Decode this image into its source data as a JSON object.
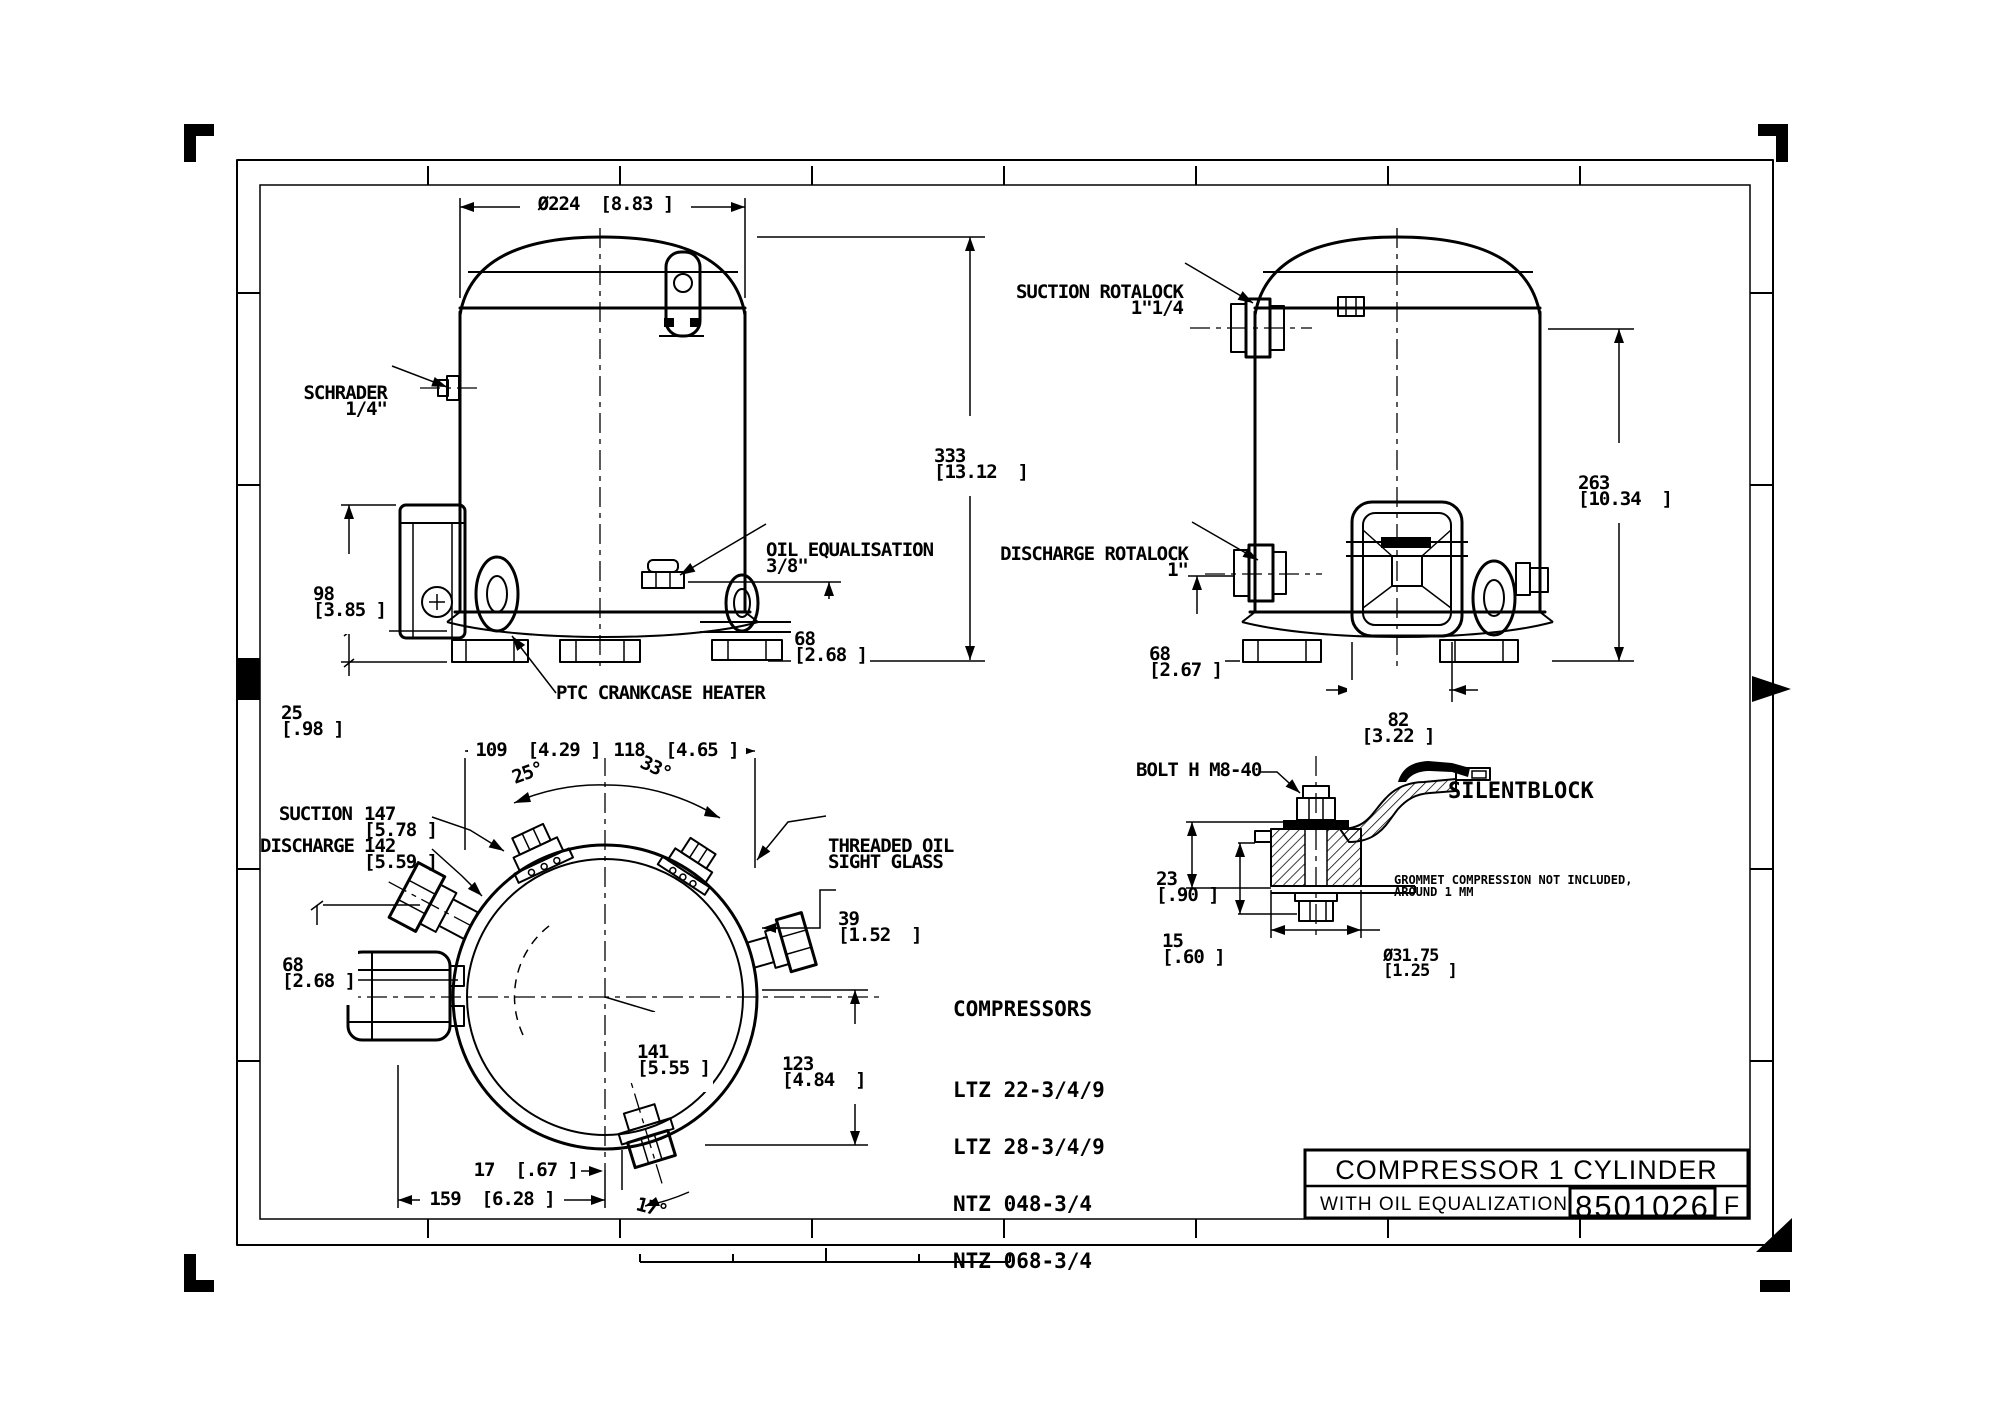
{
  "front_view": {
    "dim_diameter": "Ø224  [8.83 ]",
    "schrader": [
      "SCHRADER",
      "1/4\""
    ],
    "dim_height": {
      "mm": "333",
      "in": "[13.12  ]"
    },
    "oil_eq": [
      "OIL EQUALISATION",
      "3/8\""
    ],
    "dim_68": {
      "mm": "68",
      "in": "[2.68 ]"
    },
    "dim_98": {
      "mm": "98",
      "in": "[3.85 ]"
    },
    "dim_25": {
      "mm": "25",
      "in": "[.98 ]"
    },
    "ptc": "PTC CRANKCASE HEATER"
  },
  "side_view": {
    "suction": [
      "SUCTION ROTALOCK",
      "1\"1/4"
    ],
    "discharge": [
      "DISCHARGE ROTALOCK",
      "1\""
    ],
    "dim_height": {
      "mm": "263",
      "in": "[10.34  ]"
    },
    "dim_68": {
      "mm": "68",
      "in": "[2.67 ]"
    },
    "dim_82": {
      "mm": "82",
      "in": "[3.22 ]"
    }
  },
  "bottom_view": {
    "dim_109": "109  [4.29 ]",
    "dim_118": "118  [4.65 ]",
    "angle_25": "25°",
    "angle_33": "33°",
    "suction_label": "SUCTION",
    "suction_mm": "147",
    "suction_in": "[5.78 ]",
    "discharge_label": "DISCHARGE",
    "discharge_mm": "142",
    "discharge_in": "[5.59 ]",
    "sight_glass": [
      "THREADED OIL",
      "SIGHT GLASS"
    ],
    "dim_39": {
      "mm": "39",
      "in": "[1.52  ]"
    },
    "dim_68": {
      "mm": "68",
      "in": "[2.68 ]"
    },
    "dim_141": {
      "mm": "141",
      "in": "[5.55 ]"
    },
    "dim_123": {
      "mm": "123",
      "in": "[4.84  ]"
    },
    "dim_17": "17  [.67 ]",
    "dim_159": "159  [6.28 ]",
    "angle_17": "17°"
  },
  "silentblock": {
    "bolt": "BOLT H M8-40",
    "title": "SILENTBLOCK",
    "note": [
      "GROMMET COMPRESSION NOT INCLUDED,",
      "AROUND 1 MM"
    ],
    "dim_23": {
      "mm": "23",
      "in": "[.90 ]"
    },
    "dim_15": {
      "mm": "15",
      "in": "[.60 ]"
    },
    "dim_dia": {
      "mm": "Ø31.75",
      "in": "[1.25  ]"
    }
  },
  "compressors": {
    "title": "COMPRESSORS",
    "models": [
      "LTZ 22-3/4/9",
      "LTZ 28-3/4/9",
      "NTZ 048-3/4",
      "NTZ 068-3/4"
    ]
  },
  "title_block": {
    "title": "COMPRESSOR 1 CYLINDER",
    "subtitle": "WITH OIL EQUALIZATION",
    "number": "8501026",
    "revision": "F"
  }
}
